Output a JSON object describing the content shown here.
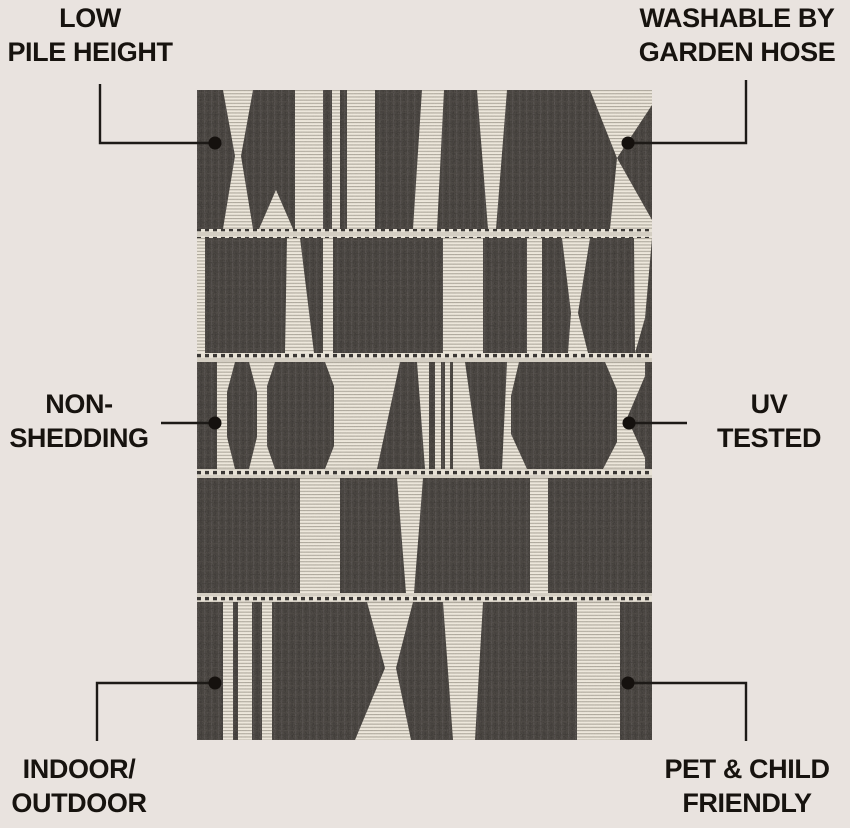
{
  "page": {
    "background_color": "#e9e3df",
    "text_color": "#17130f",
    "line_color": "#1d1a17"
  },
  "rug": {
    "name": "black-cream-geometric-flatweave-rug",
    "dark_color": "#3b3733",
    "cream_color": "#ece6da",
    "stripe_line_color": "#a8a296"
  },
  "features": {
    "top_left": {
      "line1": "LOW",
      "line2": "PILE HEIGHT"
    },
    "top_right": {
      "line1": "WASHABLE BY",
      "line2": "GARDEN HOSE"
    },
    "mid_left": {
      "line1": "NON-",
      "line2": "SHEDDING"
    },
    "mid_right": {
      "line1": "UV",
      "line2": "TESTED"
    },
    "bottom_left": {
      "line1": "INDOOR/",
      "line2": "OUTDOOR"
    },
    "bottom_right": {
      "line1": "PET & CHILD",
      "line2": "FRIENDLY"
    }
  }
}
